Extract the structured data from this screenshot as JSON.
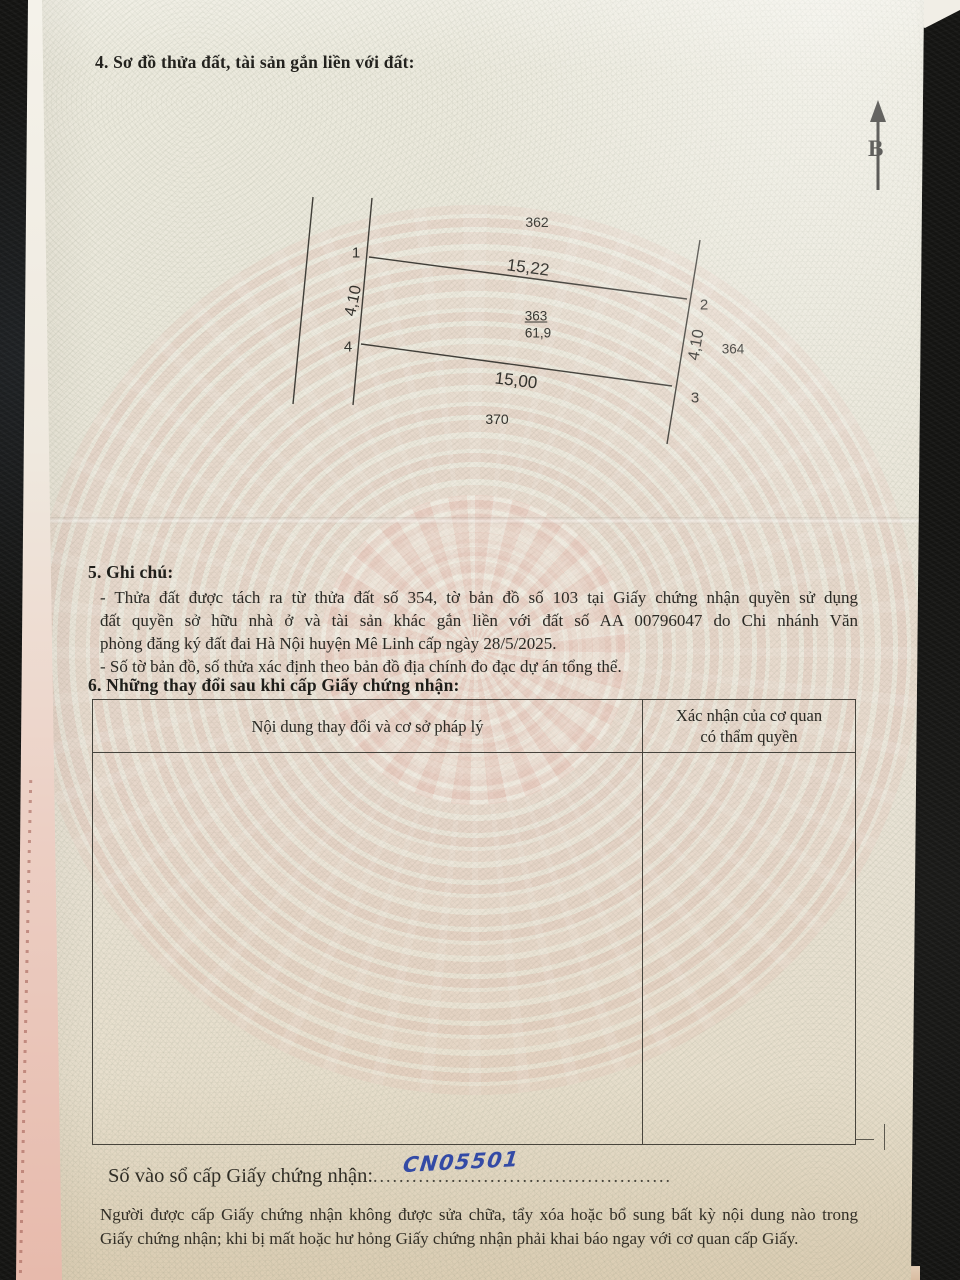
{
  "page": {
    "section4_title": "4. Sơ đồ thửa đất, tài sản gắn liền với đất:",
    "north_label": "B",
    "diagram": {
      "adjacent_top": "362",
      "adjacent_right": "364",
      "adjacent_bottom": "370",
      "parcel_number": "363",
      "parcel_area": "61,9",
      "corner_1": "1",
      "corner_2": "2",
      "corner_3": "3",
      "corner_4": "4",
      "edge_top_length": "15,22",
      "edge_bottom_length": "15,00",
      "edge_left_length": "4,10",
      "edge_right_length": "4,10"
    },
    "section5_title": "5. Ghi chú:",
    "note_line1": "- Thửa đất được tách ra từ thửa đất số 354, tờ bản đồ số 103 tại Giấy chứng nhận quyền sử dụng",
    "note_line2": "đất quyền sở hữu nhà ở và tài sản khác gắn liền với đất số AA 00796047 do Chi nhánh Văn",
    "note_line3": "phòng đăng ký đất đai Hà Nội huyện Mê Linh cấp ngày 28/5/2025.",
    "note_line4": "- Số tờ bản đồ, số thửa xác định theo bản đồ địa chính đo đạc dự án tổng thể.",
    "section6_title": "6. Những thay đổi sau khi cấp Giấy chứng nhận:",
    "table": {
      "col1_header": "Nội dung thay đổi và cơ sở pháp lý",
      "col2_header_line1": "Xác nhận của cơ quan",
      "col2_header_line2": "có thẩm quyền"
    },
    "registry_label": "Số vào sổ cấp Giấy chứng nhận:",
    "registry_dots_leading": "....",
    "registry_number": "CN05501",
    "registry_dots_trailing": "..........................................",
    "footer_line1": "Người được cấp Giấy chứng nhận không được sửa chữa, tẩy xóa hoặc bổ sung bất kỳ nội dung nào trong",
    "footer_line2": "Giấy chứng nhận; khi bị mất hoặc hư hỏng Giấy chứng nhận phải khai báo ngay với cơ quan cấp Giấy.",
    "ink_color": "#2f49ab",
    "accent_watermark_color": "#dda49a"
  }
}
